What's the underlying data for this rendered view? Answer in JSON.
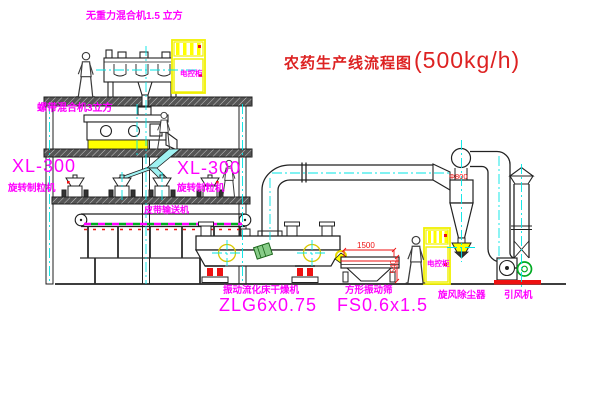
{
  "title": {
    "name": "农药生产线流程图",
    "capacity": "(500kg/h)"
  },
  "equipment_labels": {
    "gravity_mixer": "无重力混合机1.5 立方",
    "ribbon_mixer": "螺带混合机3立方",
    "granulator_left_model": "XL-300",
    "granulator_left_name": "旋转制粒机",
    "granulator_right_model": "XL-300",
    "granulator_right_name": "旋转制粒机",
    "belt_conveyor": "皮带输送机",
    "dryer_name": "振动流化床干燥机",
    "dryer_model": "ZLG6x0.75",
    "screen_name": "方形振动筛",
    "screen_model": "FS0.6x1.5",
    "cyclone": "旋风除尘器",
    "fan": "引风机"
  },
  "dimensions": {
    "screen_length": "1500",
    "screen_height": "540",
    "cyclone_diameter": "Φ800"
  },
  "control_cabinets": {
    "cabinet1_text": "电控柜",
    "cabinet2_text": "电控柜"
  },
  "colors": {
    "background": "#ffffff",
    "line": "#1f1f1f",
    "cad_yellow": "#ffff00",
    "cad_cyan": "#00e5e5",
    "cad_magenta": "#ff00ff",
    "cad_red": "#ee1111",
    "cad_green": "#00aa22",
    "title_red": "#dd2222"
  }
}
